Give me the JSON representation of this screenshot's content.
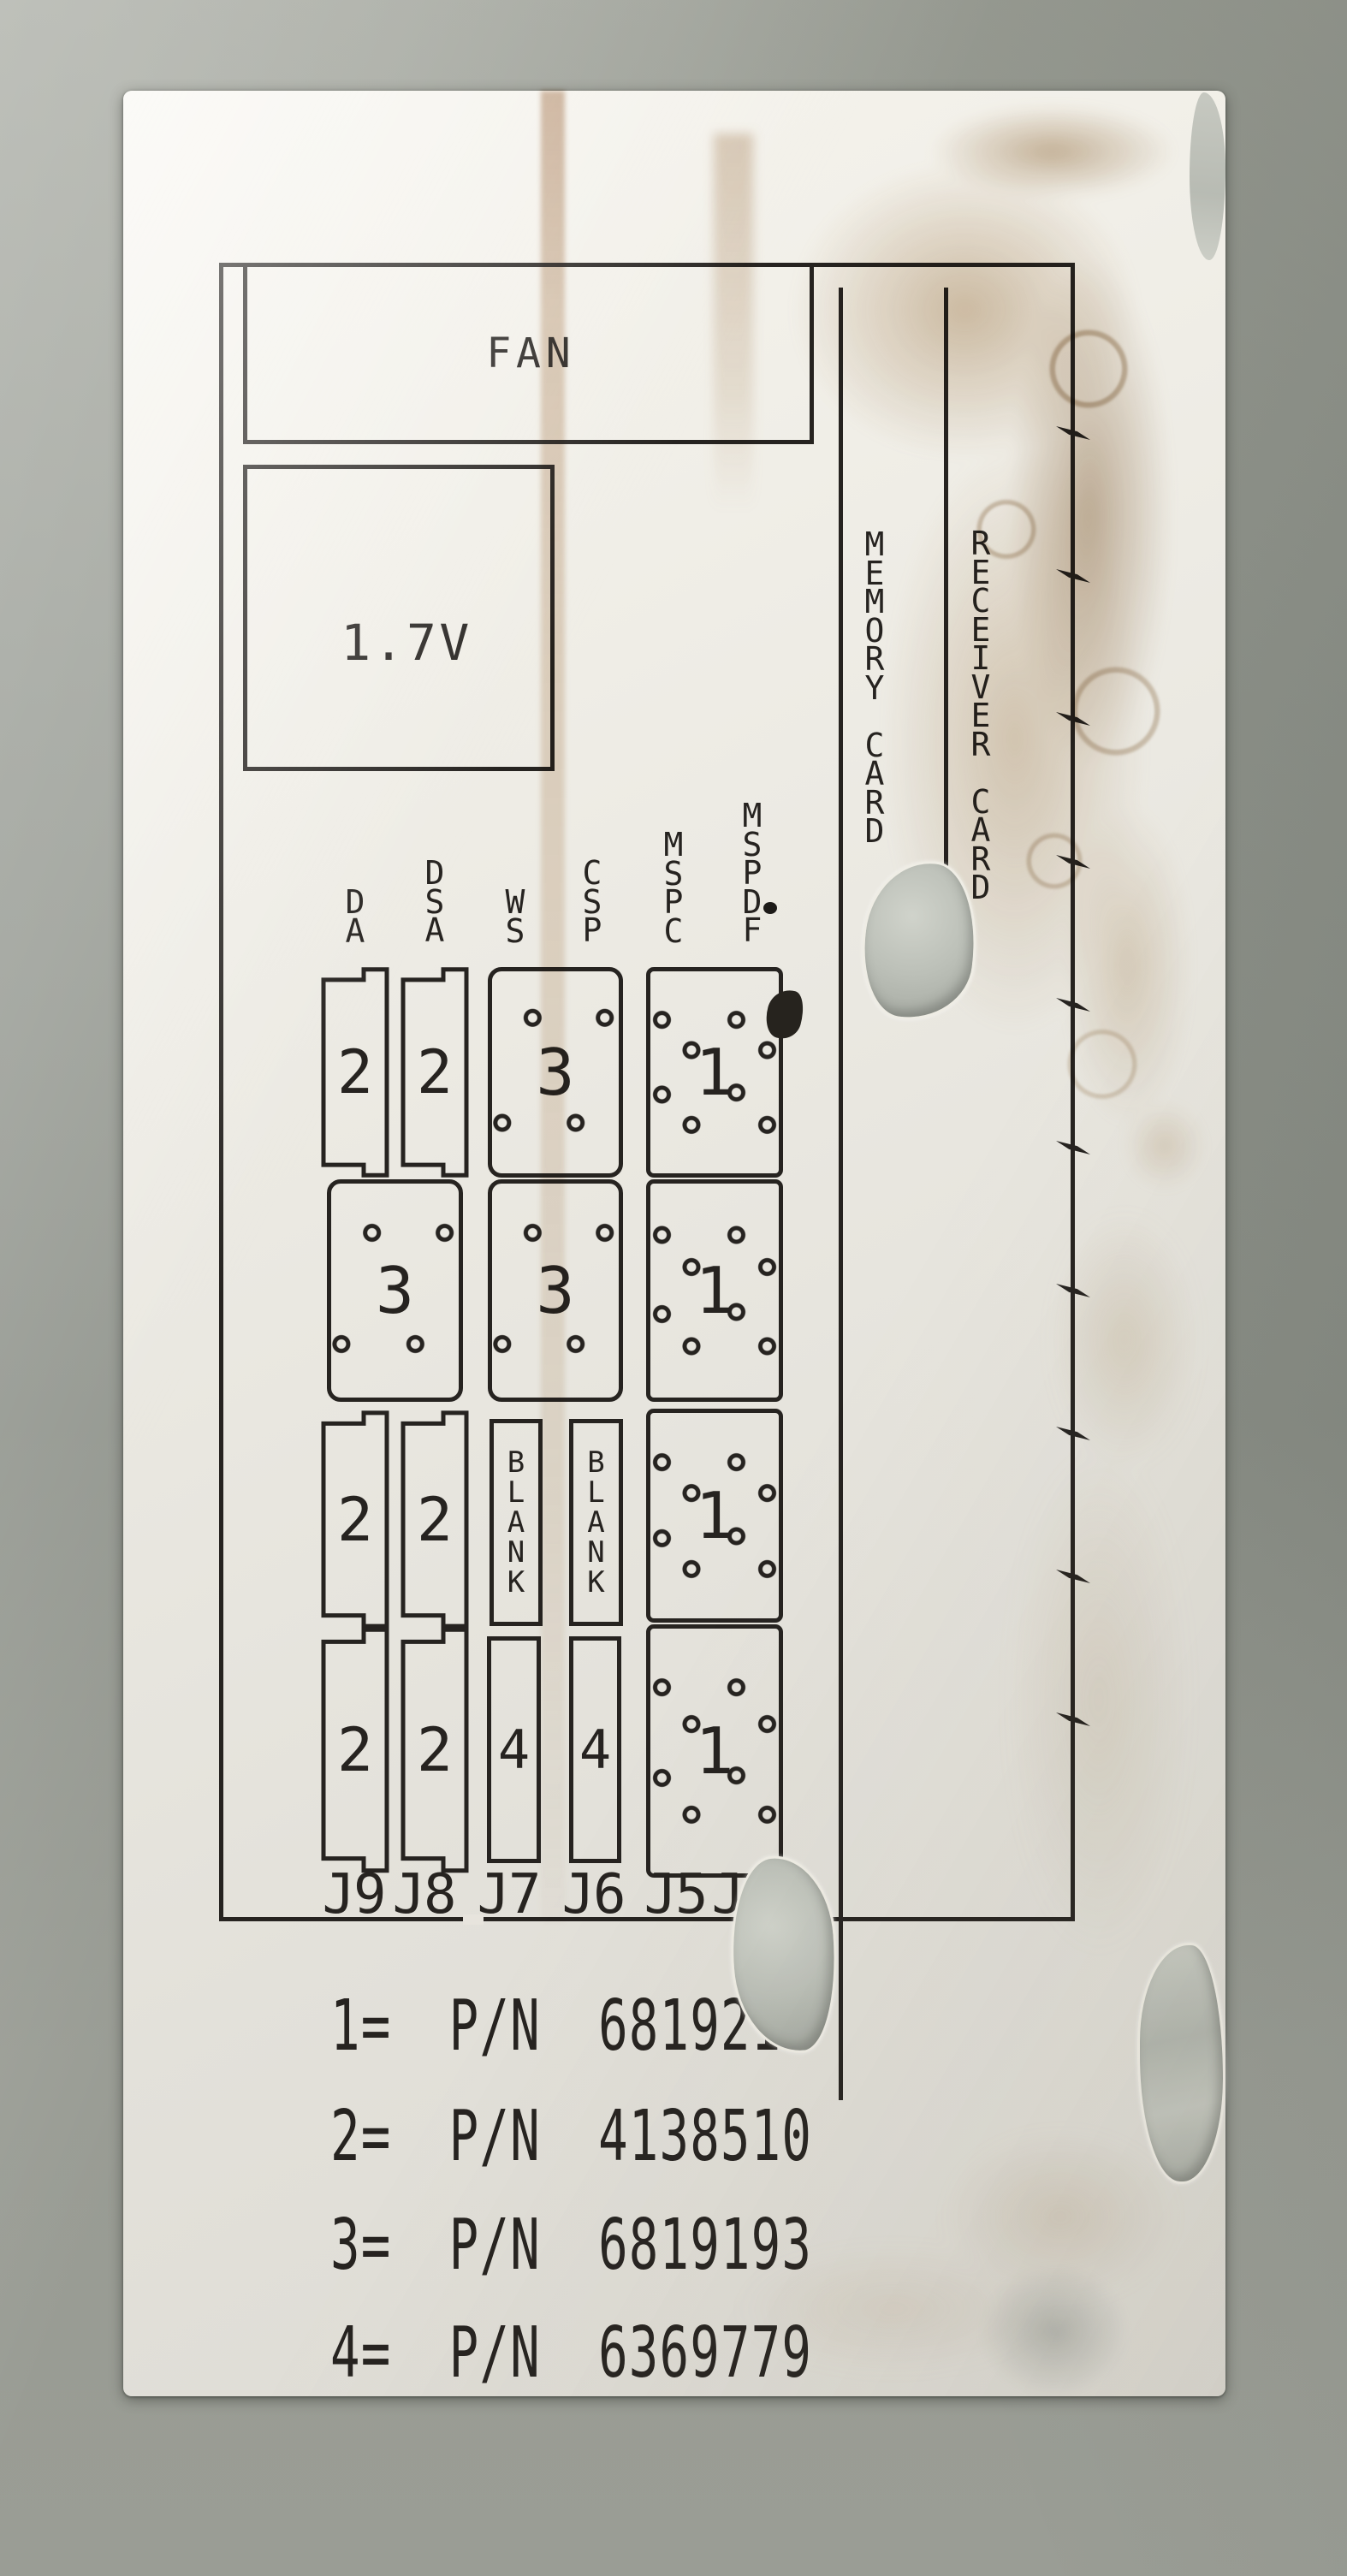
{
  "palette": {
    "ink": "#262320",
    "label_paper": "#eae7e0",
    "wall_gray": "#8f938b",
    "stain_brown": "#a97f4e",
    "torn_metal_silver": "#bcc0b8"
  },
  "diagram": {
    "fan_label": "FAN",
    "voltage_label": "1.7V",
    "memory_card_label": "MEMORY CARD",
    "receiver_card_label": "RECEIVER CARD",
    "column_headers": [
      "DA",
      "DSA",
      "WS",
      "CSP",
      "MSPC",
      "MSPDF"
    ],
    "grid": {
      "row1": {
        "c1": "2",
        "c2": "2",
        "c3": "3",
        "c4": "1"
      },
      "row2": {
        "c1": "3",
        "c2": "3",
        "c3": "1"
      },
      "row3": {
        "c1": "2",
        "c2": "2",
        "c3": "BLANK",
        "c4": "BLANK",
        "c5": "1"
      },
      "row4": {
        "c1": "2",
        "c2": "2",
        "c3": "4",
        "c4": "4",
        "c5": "1"
      }
    },
    "connector_labels": [
      "J9",
      "J8",
      "J7",
      "J6",
      "J5",
      "J4"
    ],
    "legend": [
      "1= P/N 6819211",
      "2= P/N 4138510",
      "3= P/N 6819193",
      "4= P/N 6369779"
    ]
  }
}
